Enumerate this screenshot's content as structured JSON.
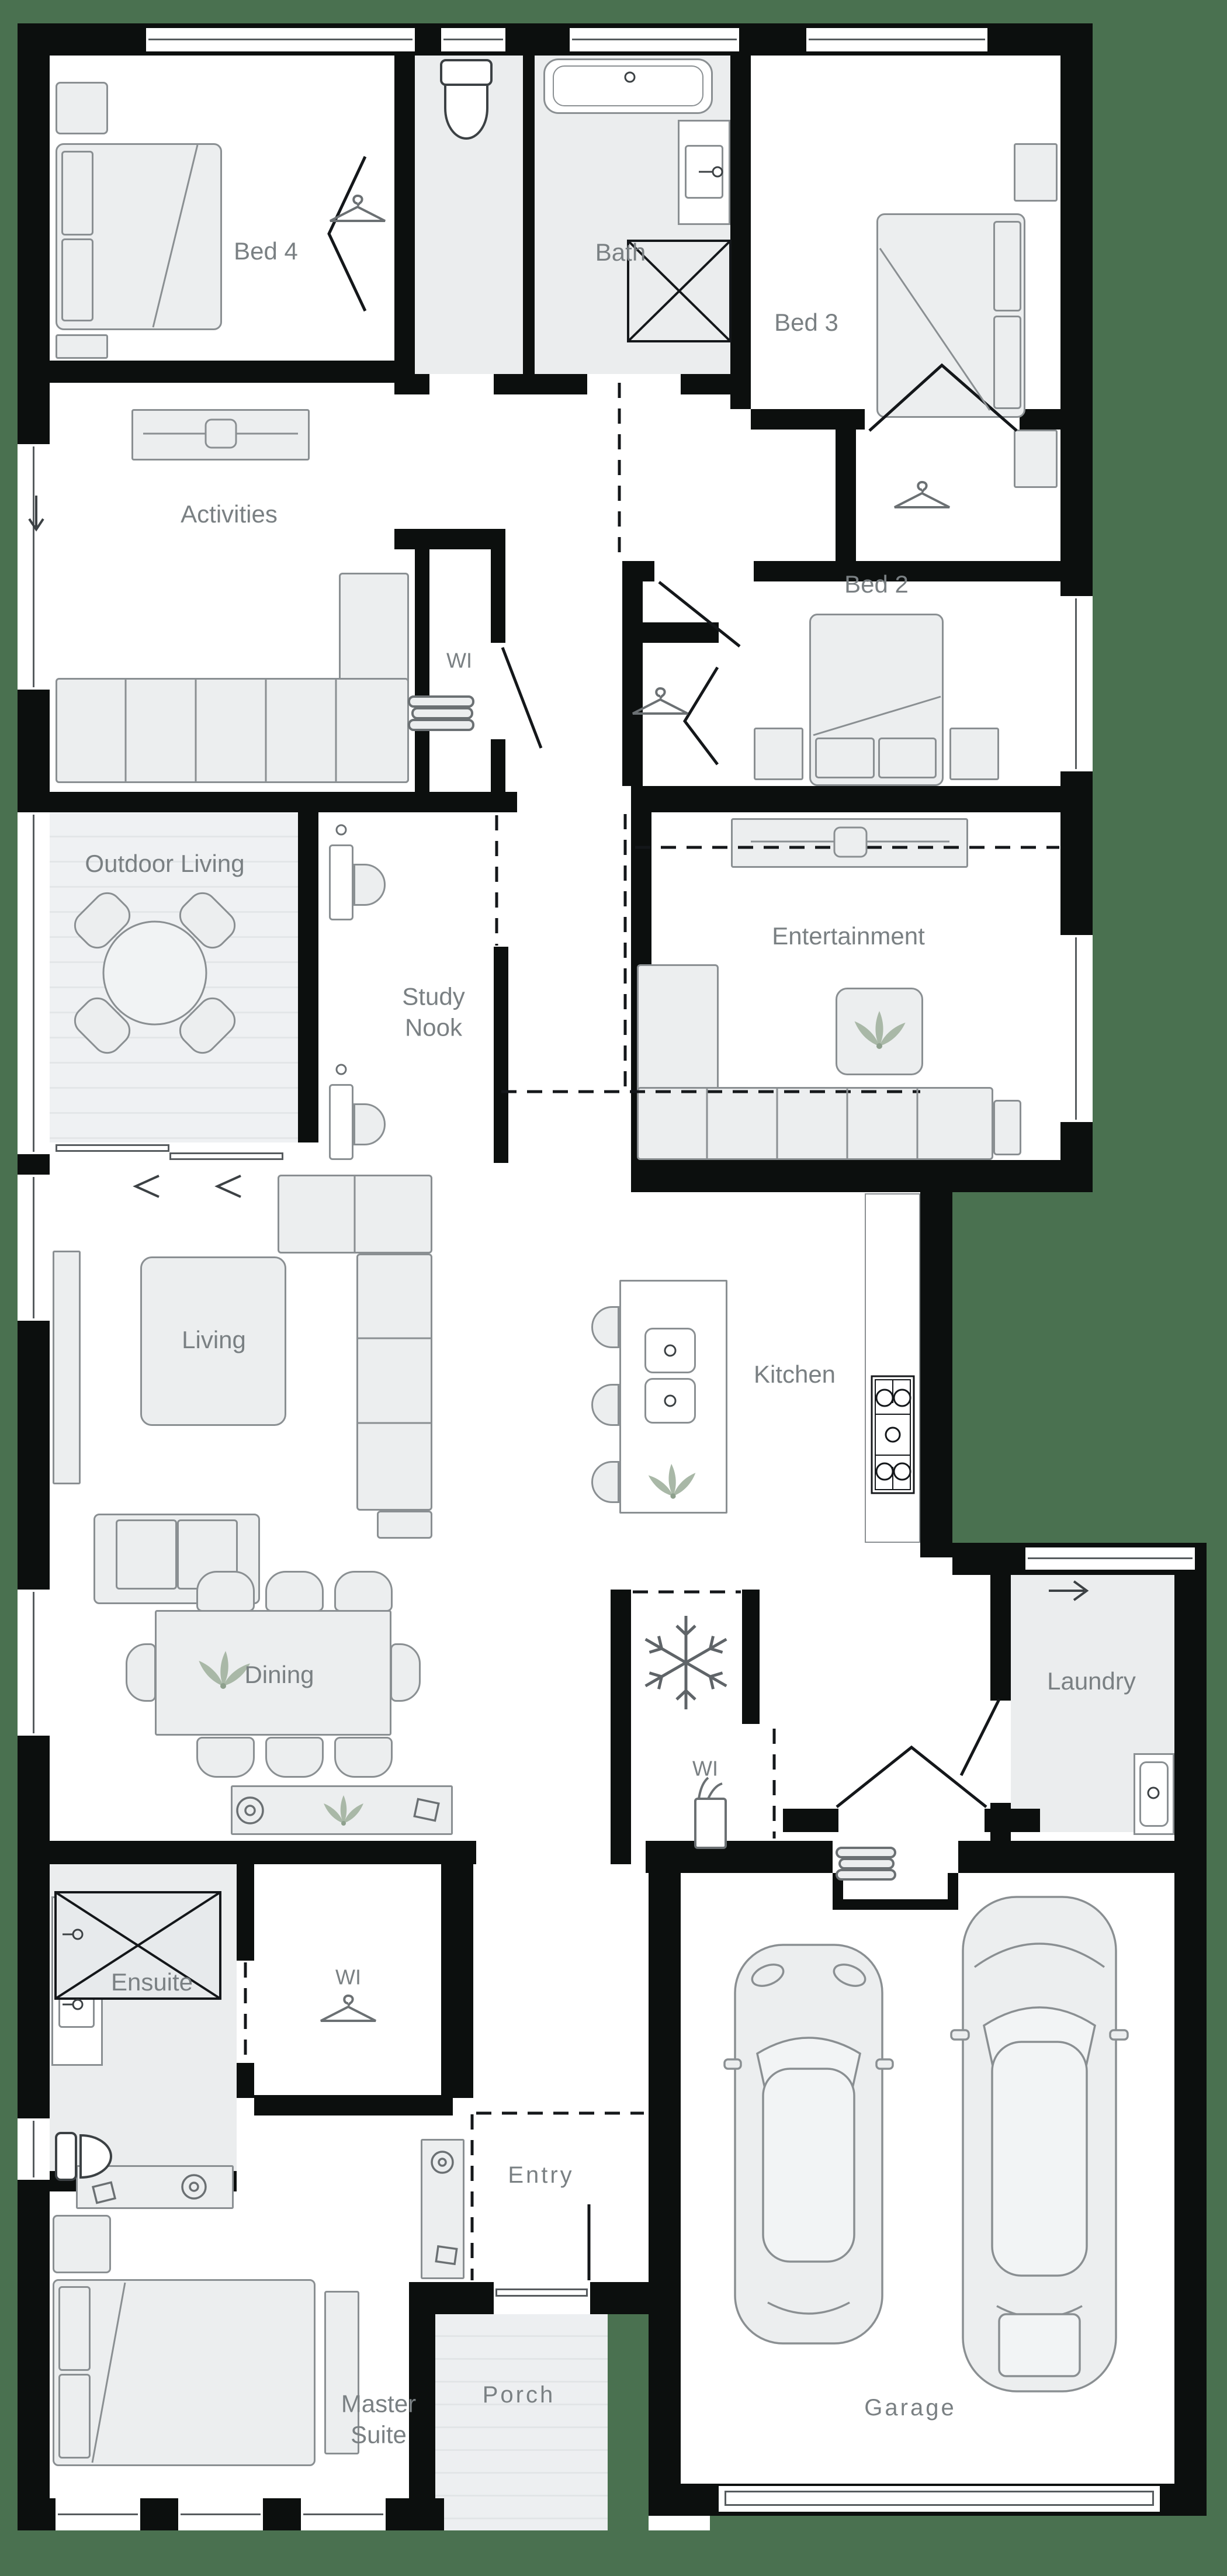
{
  "title": "Single storey house floor plan",
  "palette": {
    "background": "#4a7150",
    "wall": "#0c0f0e",
    "floor": "#ffffff",
    "wet_floor": "#ebedee",
    "furniture_fill": "#eceeef",
    "furniture_stroke": "#8a8f92",
    "label": "#7a8083",
    "plant": "#a9b8a7"
  },
  "rooms": [
    {
      "id": "bed4",
      "label": "Bed 4"
    },
    {
      "id": "bath",
      "label": "Bath"
    },
    {
      "id": "bed3",
      "label": "Bed 3"
    },
    {
      "id": "activities",
      "label": "Activities"
    },
    {
      "id": "wi_linen",
      "label": "WI"
    },
    {
      "id": "bed2",
      "label": "Bed 2"
    },
    {
      "id": "outdoor_living",
      "label": "Outdoor Living"
    },
    {
      "id": "study_nook",
      "label": "Study Nook"
    },
    {
      "id": "entertainment",
      "label": "Entertainment"
    },
    {
      "id": "living",
      "label": "Living"
    },
    {
      "id": "kitchen",
      "label": "Kitchen"
    },
    {
      "id": "dining",
      "label": "Dining"
    },
    {
      "id": "laundry",
      "label": "Laundry"
    },
    {
      "id": "wi_pantry",
      "label": "WI"
    },
    {
      "id": "ensuite",
      "label": "Ensuite"
    },
    {
      "id": "wi_robe",
      "label": "WI"
    },
    {
      "id": "entry",
      "label": "Entry"
    },
    {
      "id": "master_suite",
      "label": "Master Suite"
    },
    {
      "id": "porch",
      "label": "Porch"
    },
    {
      "id": "garage",
      "label": "Garage"
    }
  ],
  "icons": {
    "hanger": "clothes-hanger outline (wardrobe)",
    "snowflake": "fridge space marker",
    "towels": "stacked linen shelves",
    "plant": "indoor plant leaves",
    "groceries": "pantry goods bag",
    "double_chevron_left": "stacker door slide direction",
    "arrow_right": "laundry external door",
    "arrow_down": "activities external door"
  }
}
